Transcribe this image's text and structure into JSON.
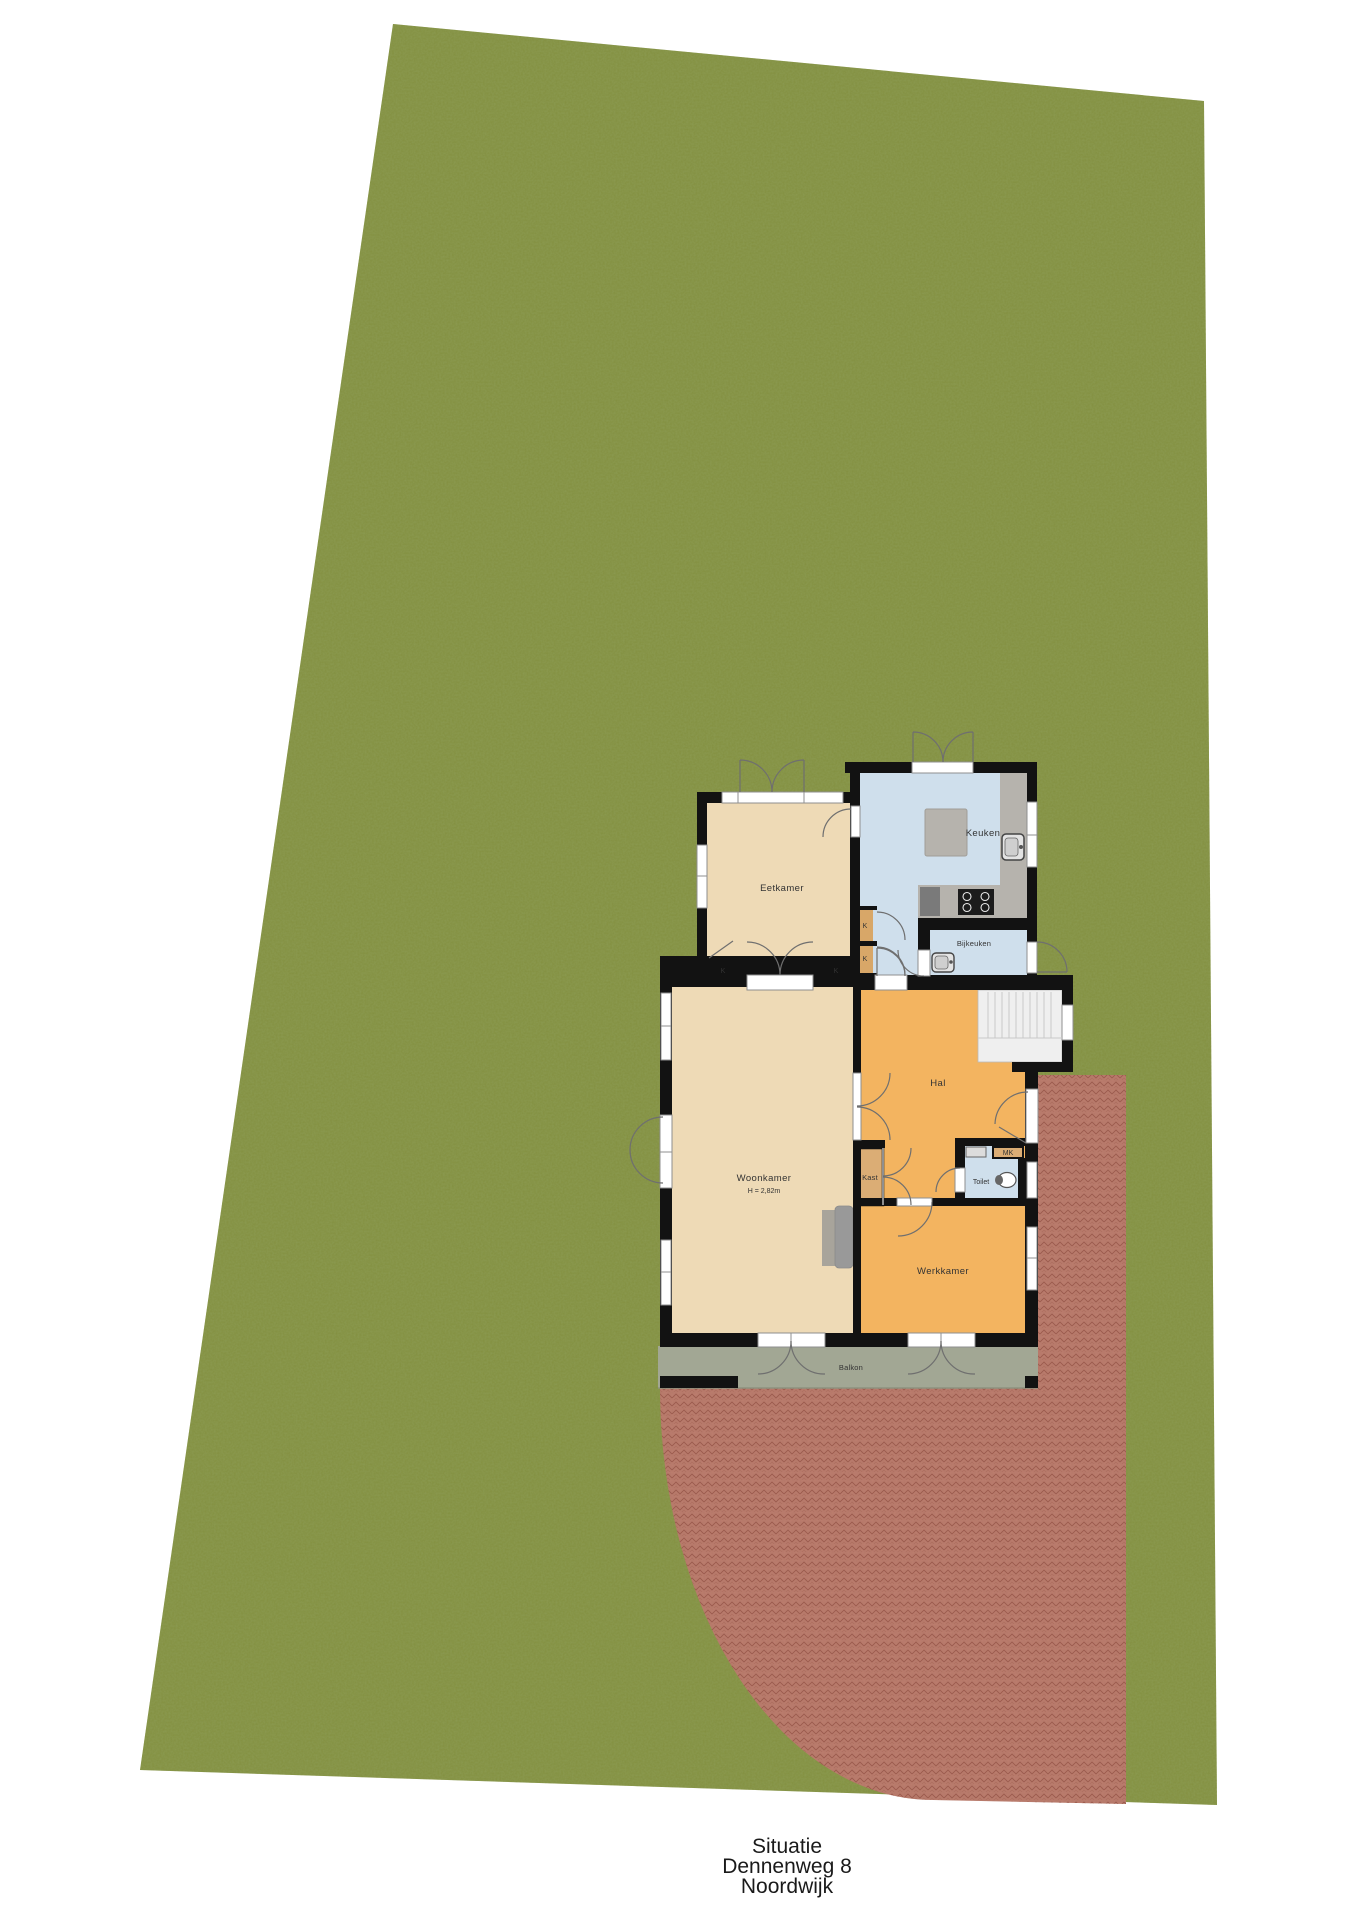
{
  "title": {
    "line1": "Situatie",
    "line2": "Dennenweg 8",
    "line3": "Noordwijk"
  },
  "rooms": {
    "eetkamer": "Eetkamer",
    "keuken": "Keuken",
    "bijkeuken": "Bijkeuken",
    "hal": "Hal",
    "woonkamer": "Woonkamer",
    "woonkamer_ceiling_height": "H = 2,82m",
    "kast": "Kast",
    "toilet": "Toilet",
    "meterkast": "MK",
    "werkkamer": "Werkkamer",
    "balkon": "Balkon",
    "closet_abbrev": "K"
  },
  "colors": {
    "background": "#ffffff",
    "grass": "#8b9a51",
    "patio": "#bd7e6f",
    "patio_line": "#9c5e4f",
    "balcony": "#a2a794",
    "wall": "#121212",
    "room_tan": "#eedab6",
    "room_orange": "#f3b460",
    "room_blue": "#cfdfec",
    "closet_tan": "#d8a768",
    "kast_tan": "#dbad75",
    "stairs": "#efefef",
    "counter": "#b6b3ad",
    "window_frame": "#8f8f8f",
    "door_arc": "#6f6f6f",
    "label": "#333333",
    "title_text": "#1a1a1a"
  }
}
